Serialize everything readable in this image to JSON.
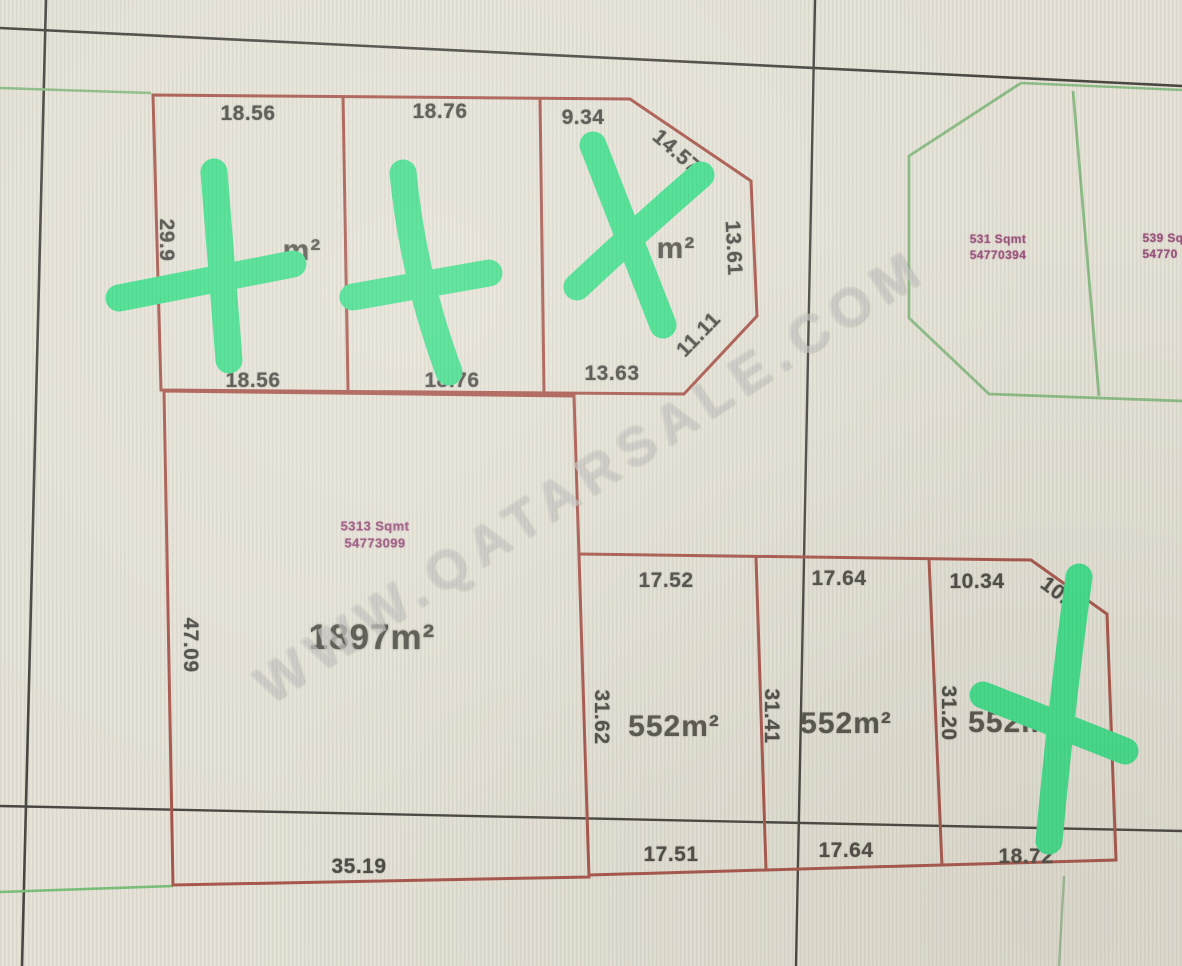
{
  "watermark": {
    "text": "WWW.QATARSALE.COM"
  },
  "colors": {
    "paper": "#e5e2d7",
    "boundary_red": "#a9544a",
    "boundary_green": "#8abc84",
    "grid_black": "#45443e",
    "cross_green": "#3ee08c",
    "dimension_text": "#4a4943",
    "area_text": "#54524a",
    "parcel_id_purple": "#96497833"
  },
  "parcels": {
    "p1": {
      "top": "18.56",
      "left": "29.9",
      "bottom": "18.56",
      "area_suffix": "m²"
    },
    "p2": {
      "top": "18.76",
      "bottom": "18.76"
    },
    "p3": {
      "top": "9.34",
      "diag_top": "14.57",
      "right": "13.61",
      "diag_bottom": "11.11",
      "bottom": "13.63",
      "area_suffix": "m²"
    },
    "p4": {
      "id_line1": "5313 Sqmt",
      "id_line2": "54773099",
      "area": "1897m²",
      "left": "47.09",
      "bottom": "35.19"
    },
    "b1": {
      "top": "17.52",
      "left": "31.62",
      "area": "552m²",
      "bottom": "17.51"
    },
    "b2": {
      "top": "17.64",
      "left": "31.41",
      "area": "552m²",
      "bottom": "17.64"
    },
    "b3": {
      "top": "10.34",
      "diag": "10.",
      "left": "31.20",
      "area": "552m²",
      "bottom": "18.72"
    },
    "g1": {
      "id_line1": "531 Sqmt",
      "id_line2": "54770394"
    },
    "g2": {
      "id_line1": "539 Sq",
      "id_line2": "54770"
    }
  }
}
